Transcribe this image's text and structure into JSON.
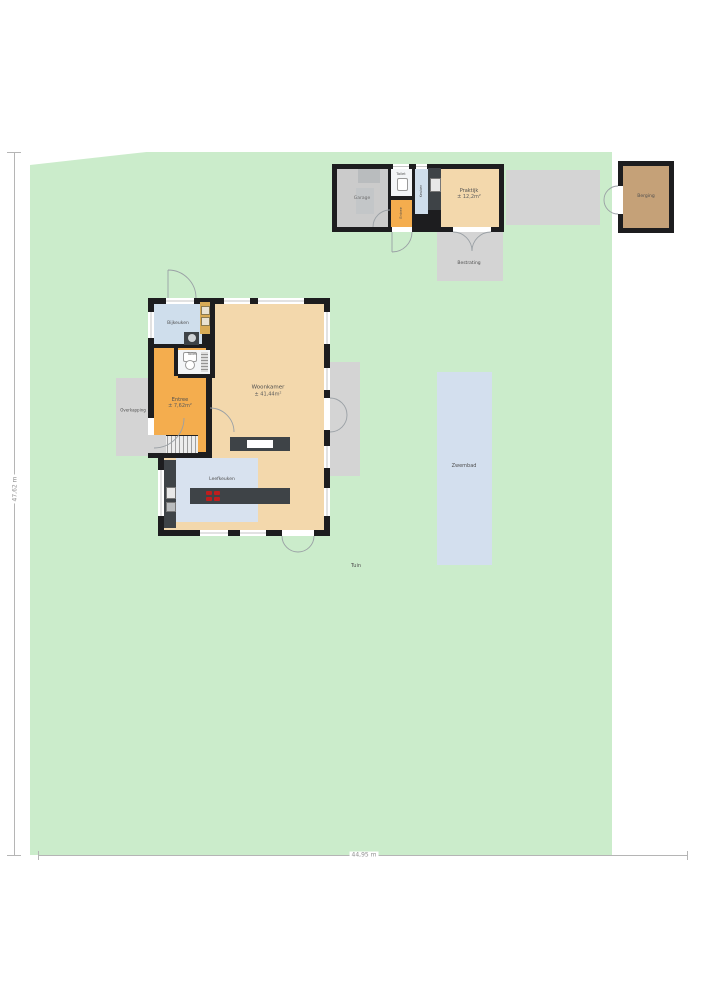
{
  "colors": {
    "plot": "#cbeccb",
    "wall": "#1d1d1f",
    "beige": "#f3d8ac",
    "orange": "#f4ad4e",
    "roomBlue": "#cfdeec",
    "kitchenBlue": "#d8e2ef",
    "pool": "#d3dfee",
    "pad": "#d4d4d4",
    "garage": "#cbcbcb",
    "mat": "#b9bcbe",
    "mat2": "#c3c6c8",
    "counter": "#3e4347",
    "cabinet": "#d8ab56",
    "berging": "#c5a178",
    "toiletFloor": "#f3f5f7",
    "white": "#ffffff"
  },
  "site": {
    "tuin": "Tuin",
    "zwembad": "Zwembad",
    "bestrating": "Bestrating",
    "overkapping": "Overkapping",
    "dim_width": "44,95 m",
    "dim_height": "47,62 m"
  },
  "house": {
    "bijkeuken": "Bijkeuken",
    "toilet": "Toilet",
    "entree": "Entree",
    "entree_size": "± 7,62m²",
    "woonkamer": "Woonkamer",
    "woonkamer_size": "± 41,44m²",
    "leefkeuken": "Leefkeuken"
  },
  "outbuilding": {
    "garage": "Garage",
    "toilet": "Toilet",
    "keuken": "Keuken",
    "entree": "Entree",
    "praktijk": "Praktijk",
    "praktijk_size": "± 12,2m²"
  },
  "annex": {
    "berging": "Berging"
  }
}
